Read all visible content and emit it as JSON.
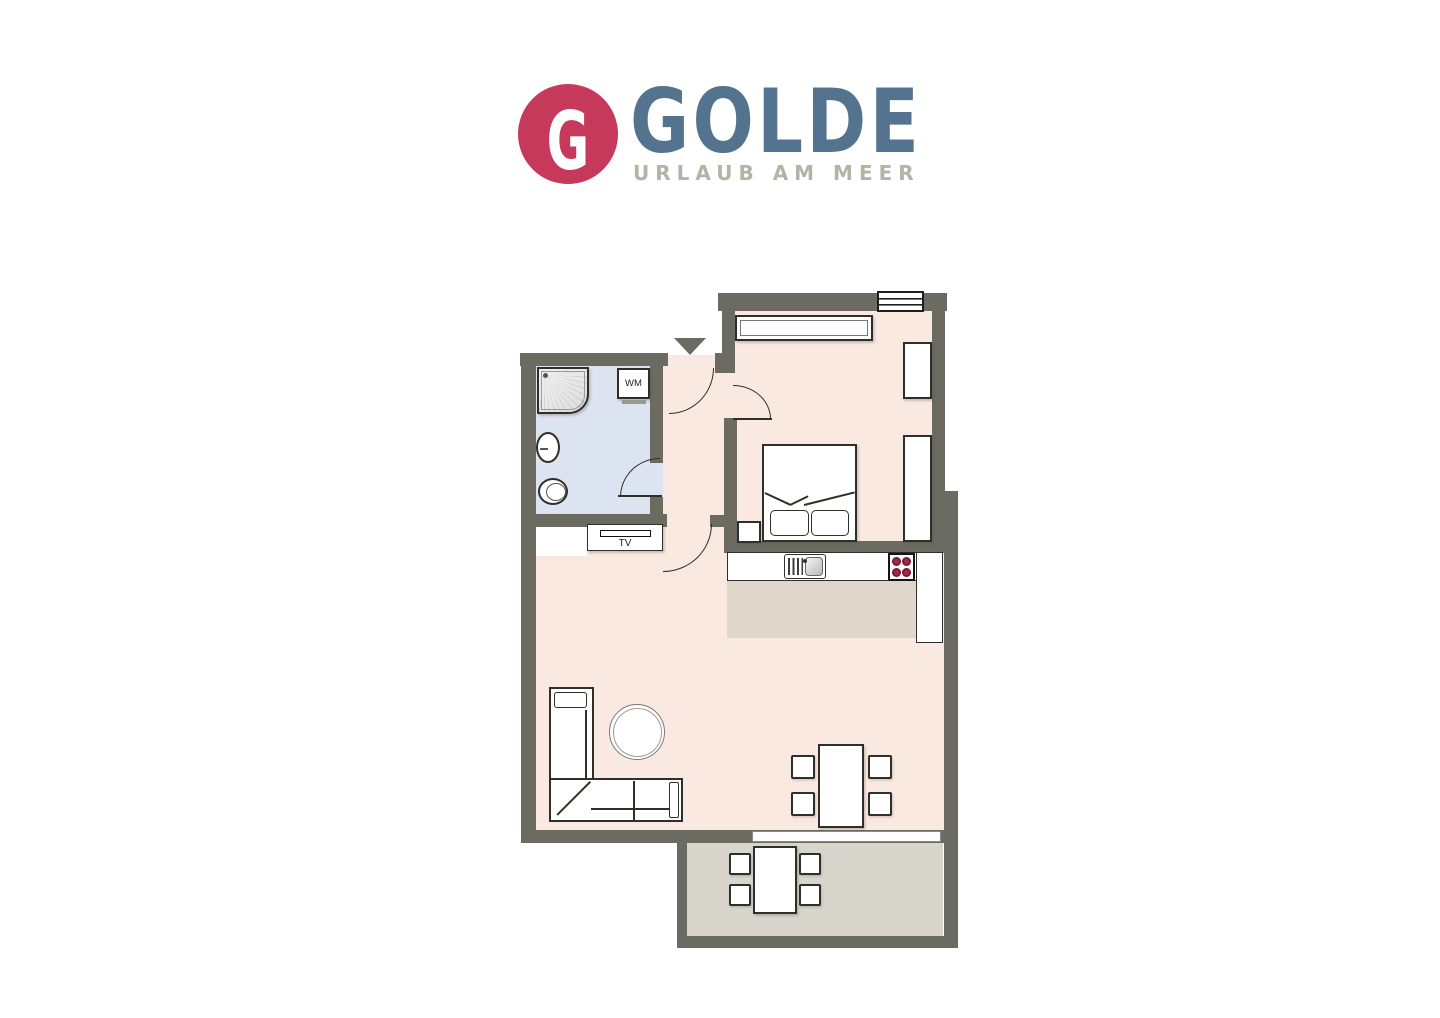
{
  "logo": {
    "monogram": "G",
    "brand": "GOLDE",
    "tagline": "URLAUB AM MEER"
  },
  "floorplan": {
    "labels": {
      "washing_machine": "WM",
      "tv": "TV"
    },
    "rooms": [
      "bathroom",
      "hallway",
      "bedroom",
      "kitchen",
      "living-room",
      "balcony"
    ]
  },
  "colors": {
    "logo_red": "#C6395B",
    "logo_blue": "#54738F",
    "logo_gray": "#B5B3A4",
    "wall": "#6B6B62",
    "line": "#2E2E2A",
    "floor_main": "#FAE9E0",
    "floor_bath": "#DCE3F1",
    "floor_kitchen": "#E1D6CB",
    "floor_balcony": "#D8D5CC",
    "burner": "#A22C4B"
  }
}
